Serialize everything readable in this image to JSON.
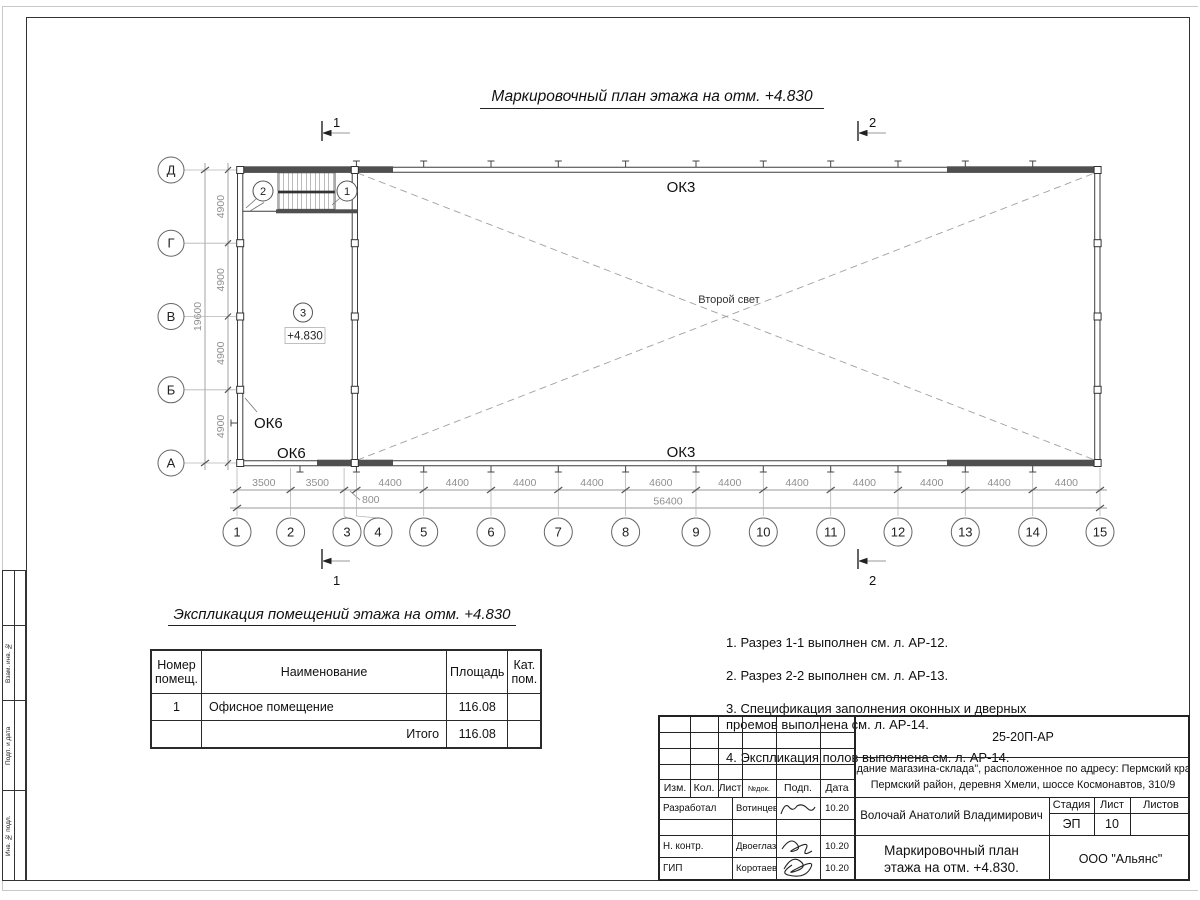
{
  "plan": {
    "title": "Маркировочный план этажа на отм. +4.830",
    "axes_h": [
      "1",
      "2",
      "3",
      "4",
      "5",
      "6",
      "7",
      "8",
      "9",
      "10",
      "11",
      "12",
      "13",
      "14",
      "15"
    ],
    "axes_v": [
      "Д",
      "Г",
      "В",
      "Б",
      "А"
    ],
    "dims_bottom": [
      "3500",
      "3500",
      "4400",
      "4400",
      "4400",
      "4400",
      "4600",
      "4400",
      "4400",
      "4400",
      "4400",
      "4400",
      "4400"
    ],
    "dim_800": "800",
    "total_bottom": "56400",
    "dims_left": [
      "4900",
      "4900",
      "4900",
      "4900"
    ],
    "total_left": "19600",
    "ok3_top": "ОК3",
    "ok3_bottom": "ОК3",
    "ok6_left": "ОК6",
    "ok6_bottom": "ОК6",
    "second_light": "Второй свет",
    "level_mark": "+4.830",
    "room_mark": "3",
    "stair_mark_left": "2",
    "stair_mark_right": "1",
    "section1": "1",
    "section2": "2"
  },
  "explication": {
    "title": "Экспликация помещений этажа на отм. +4.830",
    "headers": [
      "Номер помещ.",
      "Наименование",
      "Площадь",
      "Кат. пом."
    ],
    "rows": [
      [
        "1",
        "Офисное помещение",
        "116.08",
        ""
      ]
    ],
    "total_label": "Итого",
    "total_value": "116.08"
  },
  "notes": [
    "1. Разрез 1-1 выполнен см. л. АР-12.",
    "2. Разрез 2-2 выполнен см. л. АР-13.",
    "3. Спецификация заполнения оконных и дверных\n    проемов выполнена см. л. АР-14.",
    "4. Экспликация полов выполнена см. л. АР-14."
  ],
  "titleblock": {
    "doc_code": "25-20П-АР",
    "address_line1": "\"Здание магазина-склада\", расположенное по адресу: Пермский край,",
    "address_line2": "Пермский район, деревня Хмели, шоссе Космонавтов, 310/9",
    "header_cells": [
      "Изм.",
      "Кол.",
      "Лист",
      "№док.",
      "Подп.",
      "Дата"
    ],
    "rows": [
      {
        "role": "Разработал",
        "name": "Вотинцева",
        "date": "10.20"
      },
      {
        "role": "Н. контр.",
        "name": "Двоеглазов",
        "date": "10.20"
      },
      {
        "role": "ГИП",
        "name": "Коротаев",
        "date": "10.20"
      }
    ],
    "chief": "Волочай Анатолий Владимирович",
    "stage_header": [
      "Стадия",
      "Лист",
      "Листов"
    ],
    "stage": "ЭП",
    "sheet_no": "10",
    "sheets_total": "",
    "drawing_title_line1": "Маркировочный план",
    "drawing_title_line2": "этажа на отм. +4.830.",
    "company": "ООО \"Альянс\""
  },
  "frame_strip": [
    "Взам. инв. №",
    "Подп. и дата",
    "Инв. № подл."
  ]
}
